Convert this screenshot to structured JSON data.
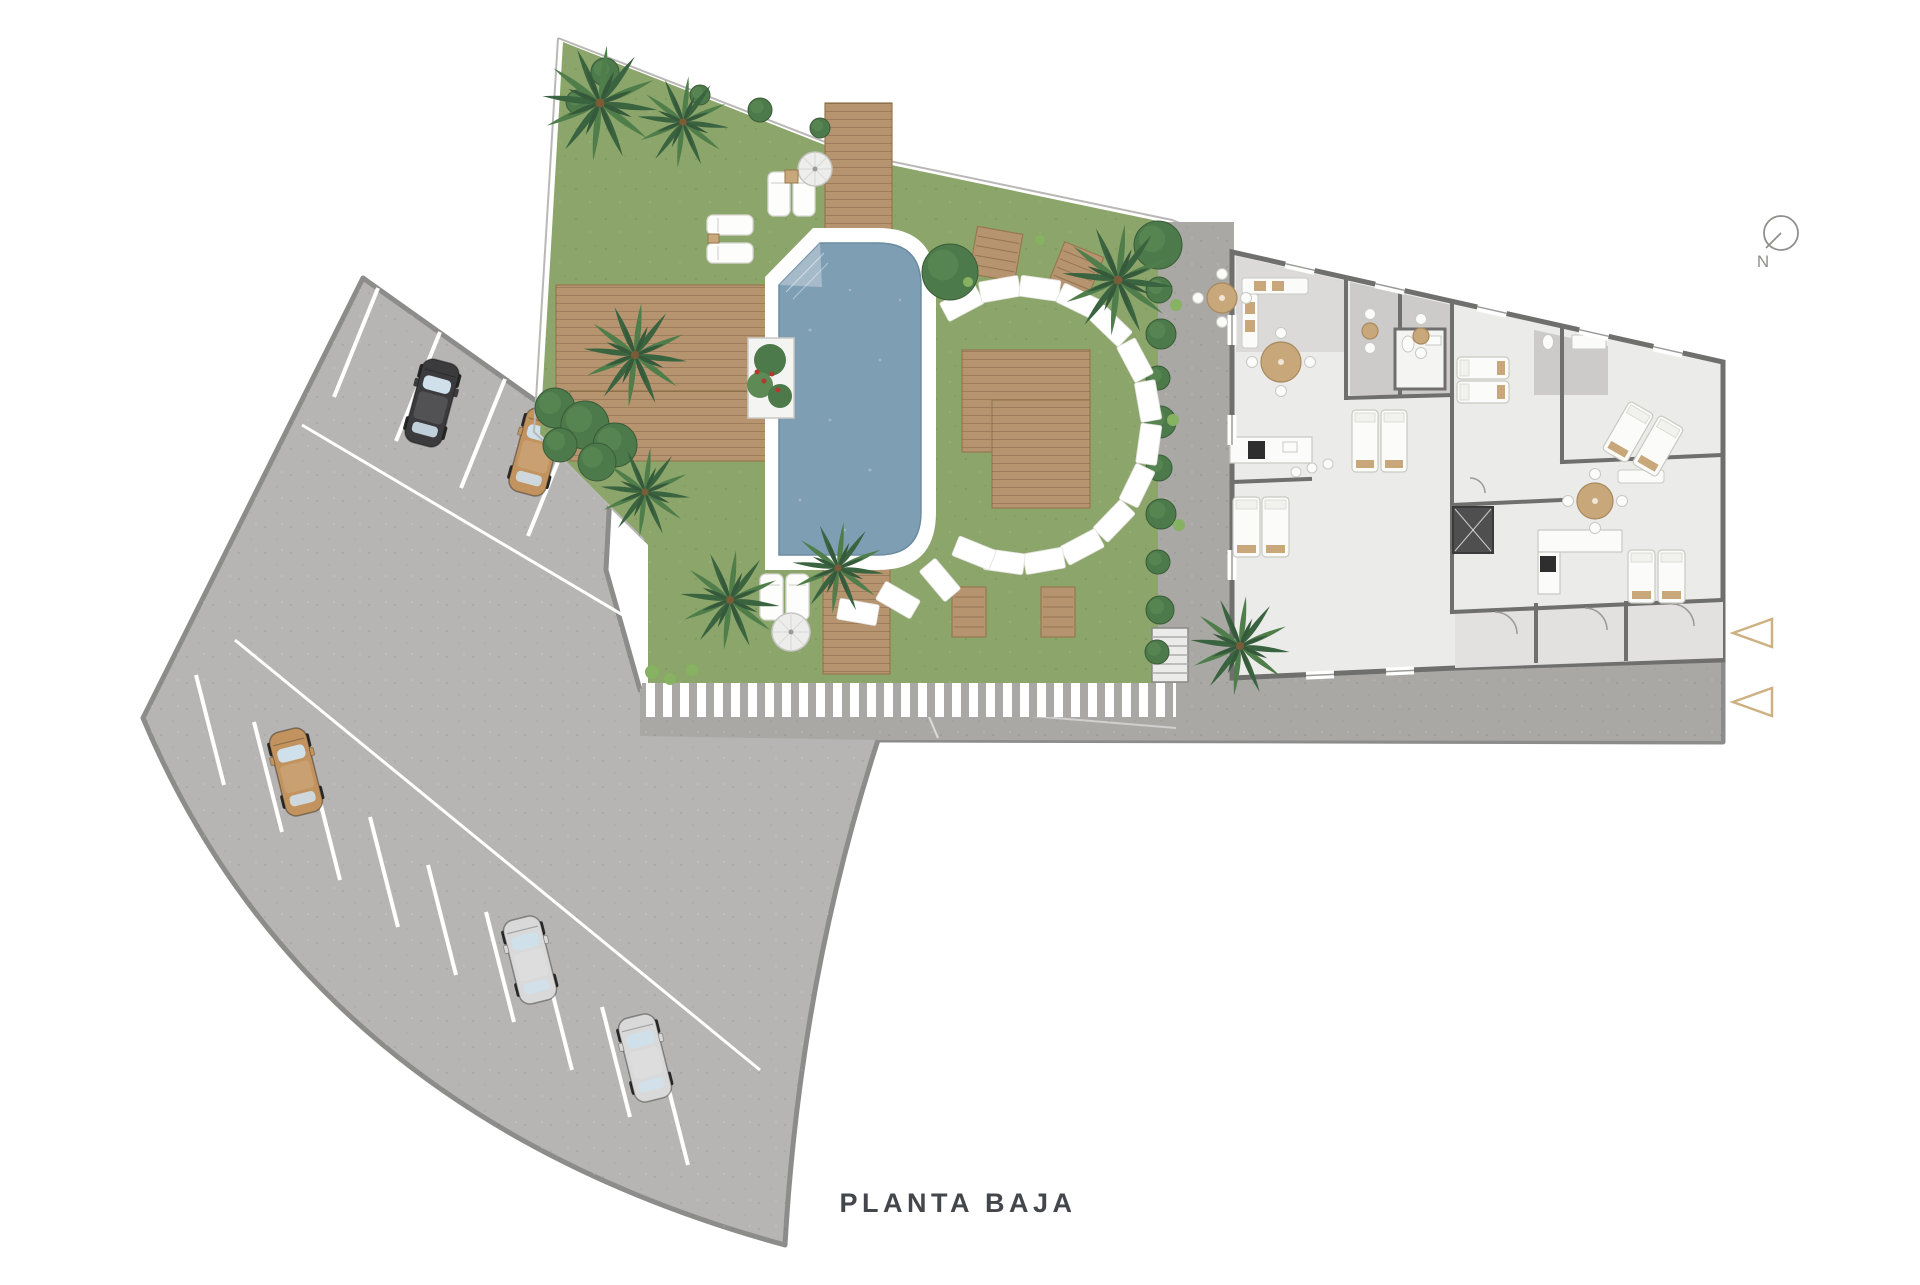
{
  "page": {
    "background": "#ffffff",
    "title_label": "PLANTA BAJA"
  },
  "compass": {
    "label": "N"
  },
  "colors": {
    "lawn": "#8CA56A",
    "lawnShade": "#7E9A5E",
    "palmDark": "#3A6340",
    "palmLight": "#4F7E4B",
    "palmInner": "#35593A",
    "bush": "#4C7A4B",
    "bushLight": "#5D8A55",
    "tuft": "#86B261",
    "deck": "#B6946F",
    "deckEdge": "#97784F",
    "poolWater": "#7E9EB4",
    "poolEdge": "#6C8CA2",
    "poolDeck": "#FFFFFF",
    "pavement": "#B6B5B3",
    "road": "#A9A8A5",
    "pavementEdge": "#8C8C8A",
    "parkLine": "#FFFFFF",
    "wall": "#6F6F6D",
    "floor": "#EBEBE9",
    "terrace": "#DBDAD8",
    "terraceDark": "#CCCBC9",
    "terraceLight": "#E2E1DF",
    "furnWhite": "#FBFBF9",
    "furnStroke": "#C9C9C3",
    "furnTan": "#C8A87A",
    "hedge": "#41683F",
    "carBlack": "#3B3B3D",
    "carTan": "#C2935F",
    "carSilver": "#D9D9D9",
    "carGlass": "#CFE0EA",
    "stone": "#FFFFFF",
    "elevator": "#4F4F4F",
    "stairs": "#C4C3C1",
    "accent": "#CDB183",
    "boundary": "#B9B8B6",
    "flower": "#B23A2E",
    "titleColor": "#43464A",
    "compassColor": "#8F8F8D"
  },
  "parking": {
    "car_count": 5,
    "cars": [
      {
        "id": "car-1",
        "color_name": "black",
        "color_ref": "carBlack"
      },
      {
        "id": "car-2",
        "color_name": "tan",
        "color_ref": "carTan"
      },
      {
        "id": "car-3",
        "color_name": "tan",
        "color_ref": "carTan"
      },
      {
        "id": "car-4",
        "color_name": "silver",
        "color_ref": "carSilver"
      },
      {
        "id": "car-5",
        "color_name": "silver",
        "color_ref": "carSilver"
      }
    ]
  },
  "garden_features": [
    "swimming-pool",
    "wood-deck",
    "palm-tree",
    "sun-lounger",
    "parasol",
    "stepping-stones",
    "garden-bench",
    "planter",
    "hedge-row"
  ],
  "building_features": [
    "apartment-units",
    "terraces",
    "bedrooms",
    "bathrooms",
    "kitchens",
    "dining-tables",
    "elevator",
    "stairs"
  ],
  "markers": {
    "entrance_arrow_count": 2
  }
}
